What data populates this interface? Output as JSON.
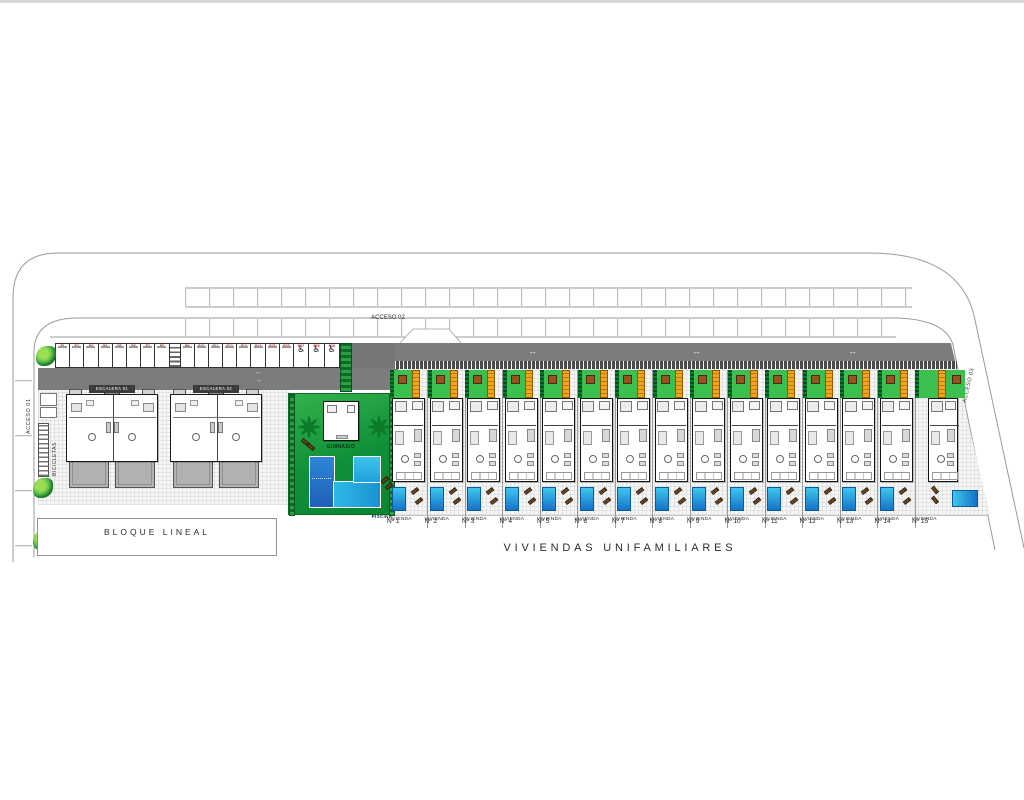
{
  "plan": {
    "title": "VIVIENDAS UNIFAMILIARES",
    "block_label": "BLOQUE LINEAL",
    "access_labels": {
      "a1": "ACCESO 01",
      "a2": "ACCESO 02",
      "a3": "ACCESO 03"
    },
    "bicycles_label": "BICICLETAS",
    "gym_label": "GIMNASIO",
    "pool_label": "PISCINA",
    "stair_units": [
      {
        "label": "ESCALERA 01"
      },
      {
        "label": "ESCALERA 02"
      }
    ],
    "villas": [
      {
        "line1": "VIVIENDA",
        "line2": "Nº 1"
      },
      {
        "line1": "VIVIENDA",
        "line2": "Nº 2"
      },
      {
        "line1": "VIVIENDA",
        "line2": "Nº 3"
      },
      {
        "line1": "VIVIENDA",
        "line2": "Nº 4"
      },
      {
        "line1": "VIVIENDA",
        "line2": "Nº 5"
      },
      {
        "line1": "VIVIENDA",
        "line2": "Nº 6"
      },
      {
        "line1": "VIVIENDA",
        "line2": "Nº 7"
      },
      {
        "line1": "VIVIENDA",
        "line2": "Nº 8"
      },
      {
        "line1": "VIVIENDA",
        "line2": "Nº 9"
      },
      {
        "line1": "VIVIENDA",
        "line2": "Nº 10"
      },
      {
        "line1": "VIVIENDA",
        "line2": "Nº 11"
      },
      {
        "line1": "VIVIENDA",
        "line2": "Nº 12"
      },
      {
        "line1": "VIVIENDA",
        "line2": "Nº 13"
      },
      {
        "line1": "VIVIENDA",
        "line2": "Nº 14"
      },
      {
        "line1": "VIVIENDA",
        "line2": "Nº 15",
        "wide": true
      }
    ],
    "parking": {
      "groups": [
        {
          "type": "regular",
          "count": 8
        },
        {
          "type": "walkway"
        },
        {
          "type": "regular",
          "count": 8
        },
        {
          "type": "handicap",
          "count": 3
        }
      ],
      "stall_labels": [
        "P1",
        "P2",
        "P3",
        "P4",
        "P5",
        "P6",
        "P7",
        "P8",
        "P9",
        "P10",
        "P11",
        "P12",
        "P13",
        "P14",
        "P15",
        "P16",
        "P17",
        "P18",
        "P19"
      ],
      "handicap_symbol": "♿",
      "stall_number_color": "#c42020"
    },
    "road_arrows": {
      "left": [
        "←",
        "→"
      ],
      "right_symbol": "↔"
    },
    "colors": {
      "grass": "#3bbf4f",
      "hedge_dark": "#0c6b28",
      "pergola": "#f2a41c",
      "pool_deep": "#1e5fb8",
      "pool_light": "#2fb9e8",
      "road_dark": "#7c7c7c",
      "wall_dark": "#4a4a4a",
      "terrace_gray": "#b1b1b1",
      "tree_brown": "#96551d"
    }
  }
}
